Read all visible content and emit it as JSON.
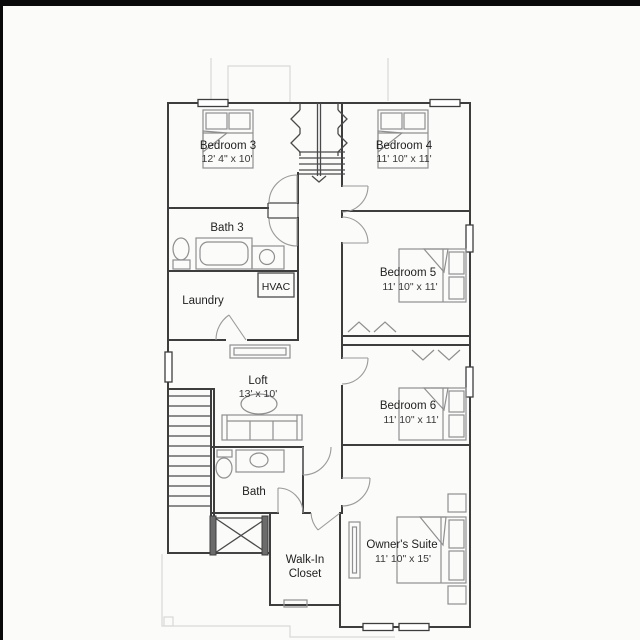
{
  "plan": {
    "type": "second-floor-plan",
    "colors": {
      "wall": "#3d3d3d",
      "furniture": "#8f8f8f",
      "faint_outline": "#d9d9d6",
      "background": "#fbfbfa",
      "frame": "#0a0a0a",
      "text": "#1f1f1f"
    },
    "rooms": {
      "bedroom3": {
        "name": "Bedroom 3",
        "dims": "12' 4\" x 10'"
      },
      "bedroom4": {
        "name": "Bedroom 4",
        "dims": "11' 10\" x 11'"
      },
      "bath3": {
        "name": "Bath 3"
      },
      "laundry": {
        "name": "Laundry"
      },
      "hvac": {
        "name": "HVAC"
      },
      "bedroom5": {
        "name": "Bedroom 5",
        "dims": "11' 10\" x 11'"
      },
      "loft": {
        "name": "Loft",
        "dims": "13' x 10'"
      },
      "bedroom6": {
        "name": "Bedroom 6",
        "dims": "11' 10\" x 11'"
      },
      "bath2": {
        "name": "Bath"
      },
      "walkin": {
        "line1": "Walk-In",
        "line2": "Closet"
      },
      "owners": {
        "name": "Owner's Suite",
        "dims": "11' 10\" x 15'"
      }
    }
  }
}
